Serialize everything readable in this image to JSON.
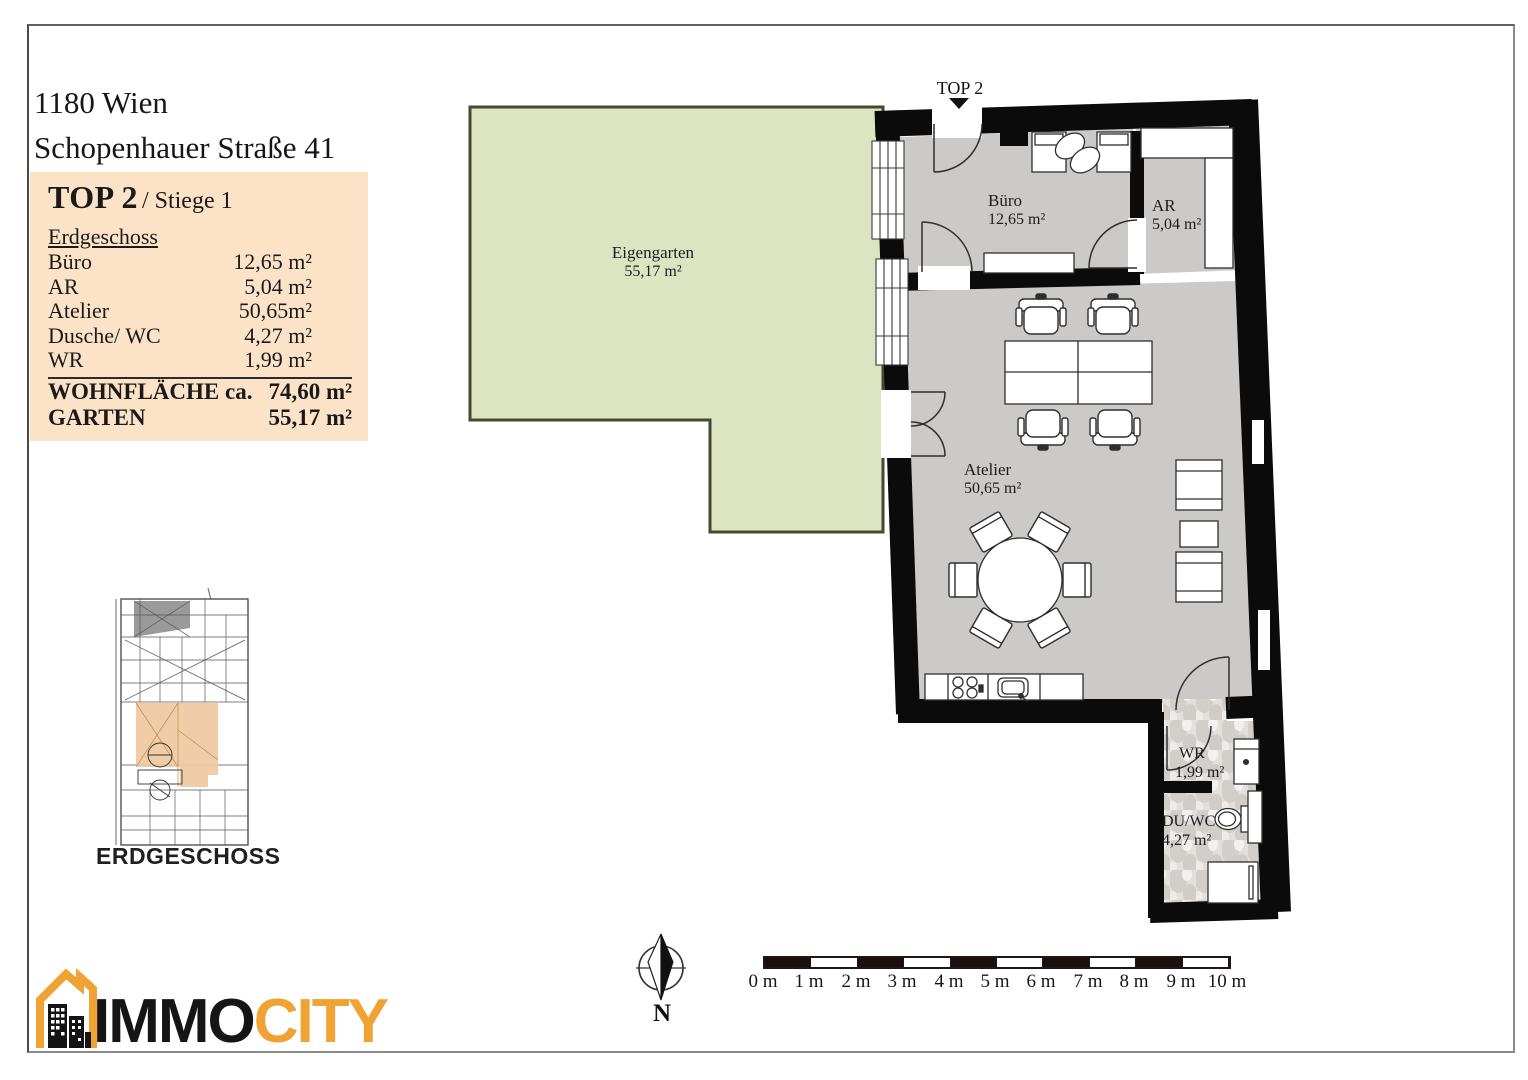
{
  "header": {
    "address_line1": "1180 Wien",
    "address_line2": "Schopenhauer Straße 41"
  },
  "info_box": {
    "title": "TOP 2",
    "subtitle": "/ Stiege 1",
    "floor": "Erdgeschoss",
    "rooms": [
      {
        "label": "Büro",
        "area": "12,65 m²"
      },
      {
        "label": "AR",
        "area": "5,04 m²"
      },
      {
        "label": "Atelier",
        "area": "50,65m²"
      },
      {
        "label": "Dusche/ WC",
        "area": "4,27 m²"
      },
      {
        "label": "WR",
        "area": "1,99 m²"
      }
    ],
    "totals": [
      {
        "label": "WOHNFLÄCHE ca.",
        "area": "74,60 m²"
      },
      {
        "label": "GARTEN",
        "area": "55,17 m²"
      }
    ]
  },
  "plan": {
    "entrance_label": "TOP 2",
    "rooms": {
      "eigengarten": {
        "name": "Eigengarten",
        "area": "55,17 m²"
      },
      "buero": {
        "name": "Büro",
        "area": "12,65 m²"
      },
      "ar": {
        "name": "AR",
        "area": "5,04 m²"
      },
      "atelier": {
        "name": "Atelier",
        "area": "50,65 m²"
      },
      "wr": {
        "name": "WR",
        "area": "1,99 m²"
      },
      "du_wc": {
        "name": "DU/WC",
        "area": "4,27 m²"
      }
    }
  },
  "mini_plan": {
    "caption": "ERDGESCHOSS"
  },
  "compass": {
    "north_label": "N"
  },
  "scale_bar": {
    "labels": [
      "0 m",
      "1 m",
      "2 m",
      "3 m",
      "4 m",
      "5 m",
      "6 m",
      "7 m",
      "8 m",
      "9 m",
      "10 m"
    ]
  },
  "logo": {
    "word_black": "IMMO",
    "word_orange": "CITY"
  },
  "colors": {
    "garden": "#dde4c2",
    "garden_border": "#45492f",
    "floor": "#cbcac8",
    "wall": "#0b0b0b",
    "info_box_bg": "#fce3c7",
    "tile_base": "#e2e0dd",
    "logo_orange": "#f0a232",
    "mini_plan_highlight": "#efc9a0"
  }
}
